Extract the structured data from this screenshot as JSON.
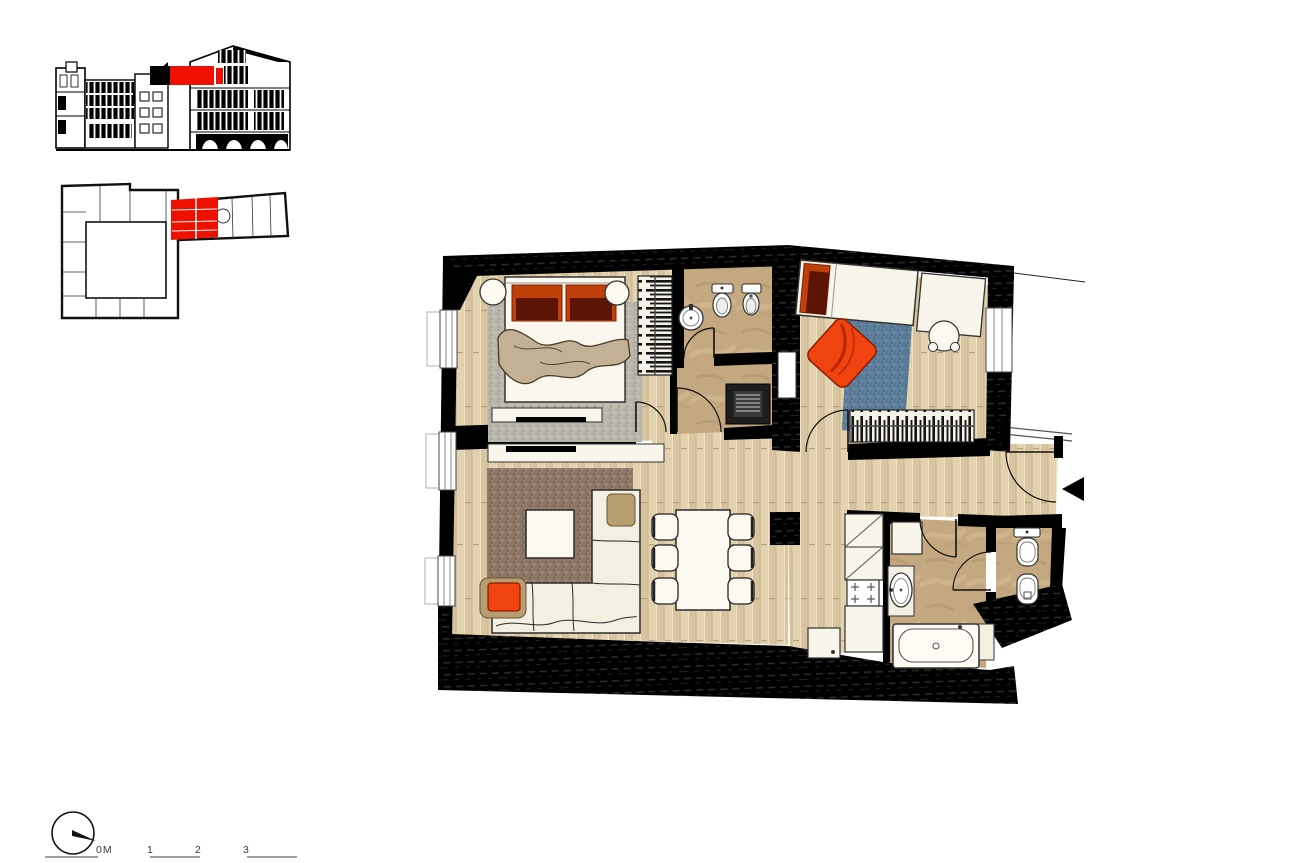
{
  "sheet": {
    "type": "residential apartment floor plan drawing",
    "scale_bar": {
      "labels": [
        "0M",
        "1",
        "2",
        "3"
      ]
    },
    "palette": {
      "highlight_red": "#f01000",
      "wall_black": "#000000",
      "wood_floor": "#decdab",
      "tile_floor": "#c4a980",
      "bedroom_rug": "#b9b7ab",
      "living_rug": "#8f7868",
      "kids_rug": "#5c7d9a",
      "accent_orange": "#f04310",
      "pillow_rust": "#c0400a",
      "pillow_maroon": "#5c1505",
      "blanket_tan": "#c3b195",
      "furniture_cream": "#f3f0e1"
    },
    "icons": {
      "north_indicator": "compass-circle-with-needle",
      "entrance_arrow": "solid-left-triangle"
    }
  }
}
